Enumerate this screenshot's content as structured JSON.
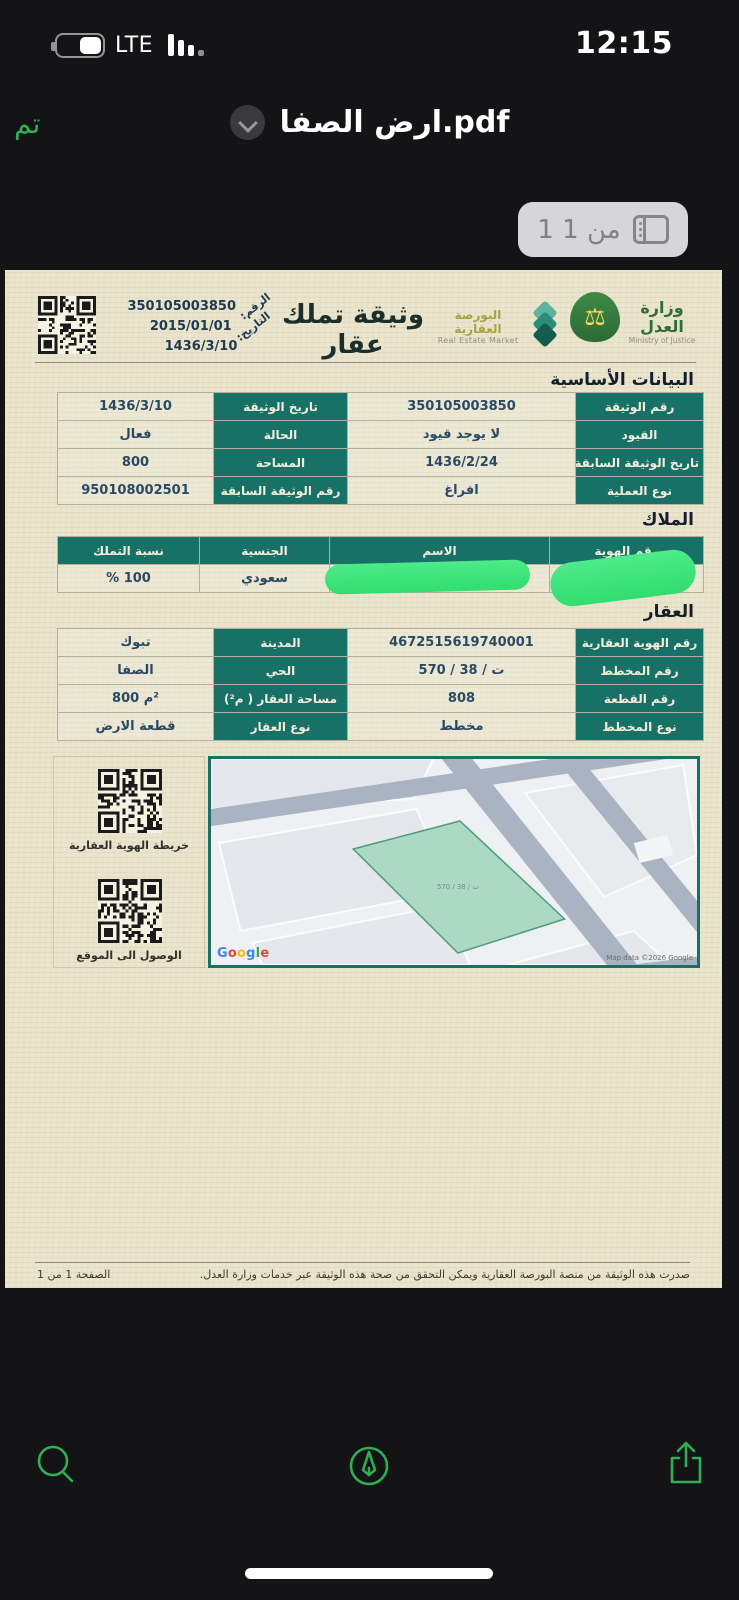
{
  "status_bar": {
    "time": "12:15",
    "network": "LTE"
  },
  "nav_bar": {
    "done_label": "تم",
    "title": "ارض الصفا.pdf"
  },
  "page_indicator": {
    "label": "1 من 1"
  },
  "document": {
    "header": {
      "title": "وثيقة تملك عقار",
      "number_label": "الرقم:",
      "number_value": "350105003850",
      "date_label": "التاريخ:",
      "date_value": "2015/01/01",
      "date_hijri": "1436/3/10",
      "market_logo_ar": "البورصة العقارية",
      "market_logo_en": "Real Estate Market",
      "moj_logo_ar": "وزارة العدل",
      "moj_logo_en": "Ministry of Justice"
    },
    "basic_section": {
      "title": "البيانات الأساسية",
      "rows": [
        {
          "label1": "رقم الوثيقة",
          "value1": "350105003850",
          "label2": "تاريخ الوثيقة",
          "value2": "1436/3/10"
        },
        {
          "label1": "القيود",
          "value1": "لا يوجد قيود",
          "label2": "الحالة",
          "value2": "فعال"
        },
        {
          "label1": "تاريخ الوثيقة السابقة",
          "value1": "1436/2/24",
          "label2": "المساحة",
          "value2": "800"
        },
        {
          "label1": "نوع العملية",
          "value1": "افراغ",
          "label2": "رقم الوثيقة السابقة",
          "value2": "950108002501"
        }
      ]
    },
    "owners_section": {
      "title": "الملاك",
      "headers": [
        "رقم الهوية",
        "الاسم",
        "الجنسية",
        "نسبة التملك"
      ],
      "row": {
        "id": "",
        "name": "",
        "nationality": "سعودي",
        "share": "% 100"
      },
      "redacted_fields": [
        "رقم الهوية",
        "الاسم"
      ]
    },
    "property_section": {
      "title": "العقار",
      "rows": [
        {
          "label1": "رقم الهوية العقارية",
          "value1": "4672515619740001",
          "label2": "المدينة",
          "value2": "تبوك"
        },
        {
          "label1": "رقم المخطط",
          "value1": "570 / 38 / ت",
          "label2": "الحي",
          "value2": "الصفا"
        },
        {
          "label1": "رقم القطعة",
          "value1": "808",
          "label2": "مساحة العقار ( م²)",
          "value2": "800 م²"
        },
        {
          "label1": "نوع المخطط",
          "value1": "مخطط",
          "label2": "نوع العقار",
          "value2": "قطعة الارض"
        }
      ]
    },
    "qr_section": {
      "map_qr_label": "خريطة الهوية العقارية",
      "location_qr_label": "الوصول الى الموقع"
    },
    "map": {
      "parcel_label": "ت / 38 / 570",
      "google_label": "Google",
      "attribution": "Map data ©2026 Google"
    },
    "footer": {
      "note": "صدرت هذه الوثيقة من منصة البورصة العقارية ويمكن التحقق من صحة هذه الوثيقة عبر خدمات وزارة العدل.",
      "page_number": "الصفحة 1 من 1"
    }
  },
  "icons": {
    "battery": "battery-icon",
    "signal": "signal-bars-icon",
    "chevron": "chevron-down-icon",
    "pages": "page-thumbnails-icon",
    "search": "search-icon",
    "markup": "markup-pen-icon",
    "share": "share-icon",
    "qr": "qr-code"
  },
  "colors": {
    "accent_green": "#2db152",
    "table_header_teal": "#177166",
    "page_background": "#e9e3cb",
    "redaction_green": "#3fe47d",
    "map_road": "#a9b3c2",
    "map_parcel_green": "#abd9c4",
    "google_letter_colors": [
      "#4285F4",
      "#EA4335",
      "#FBBC05",
      "#4285F4",
      "#34A853",
      "#EA4335"
    ]
  }
}
